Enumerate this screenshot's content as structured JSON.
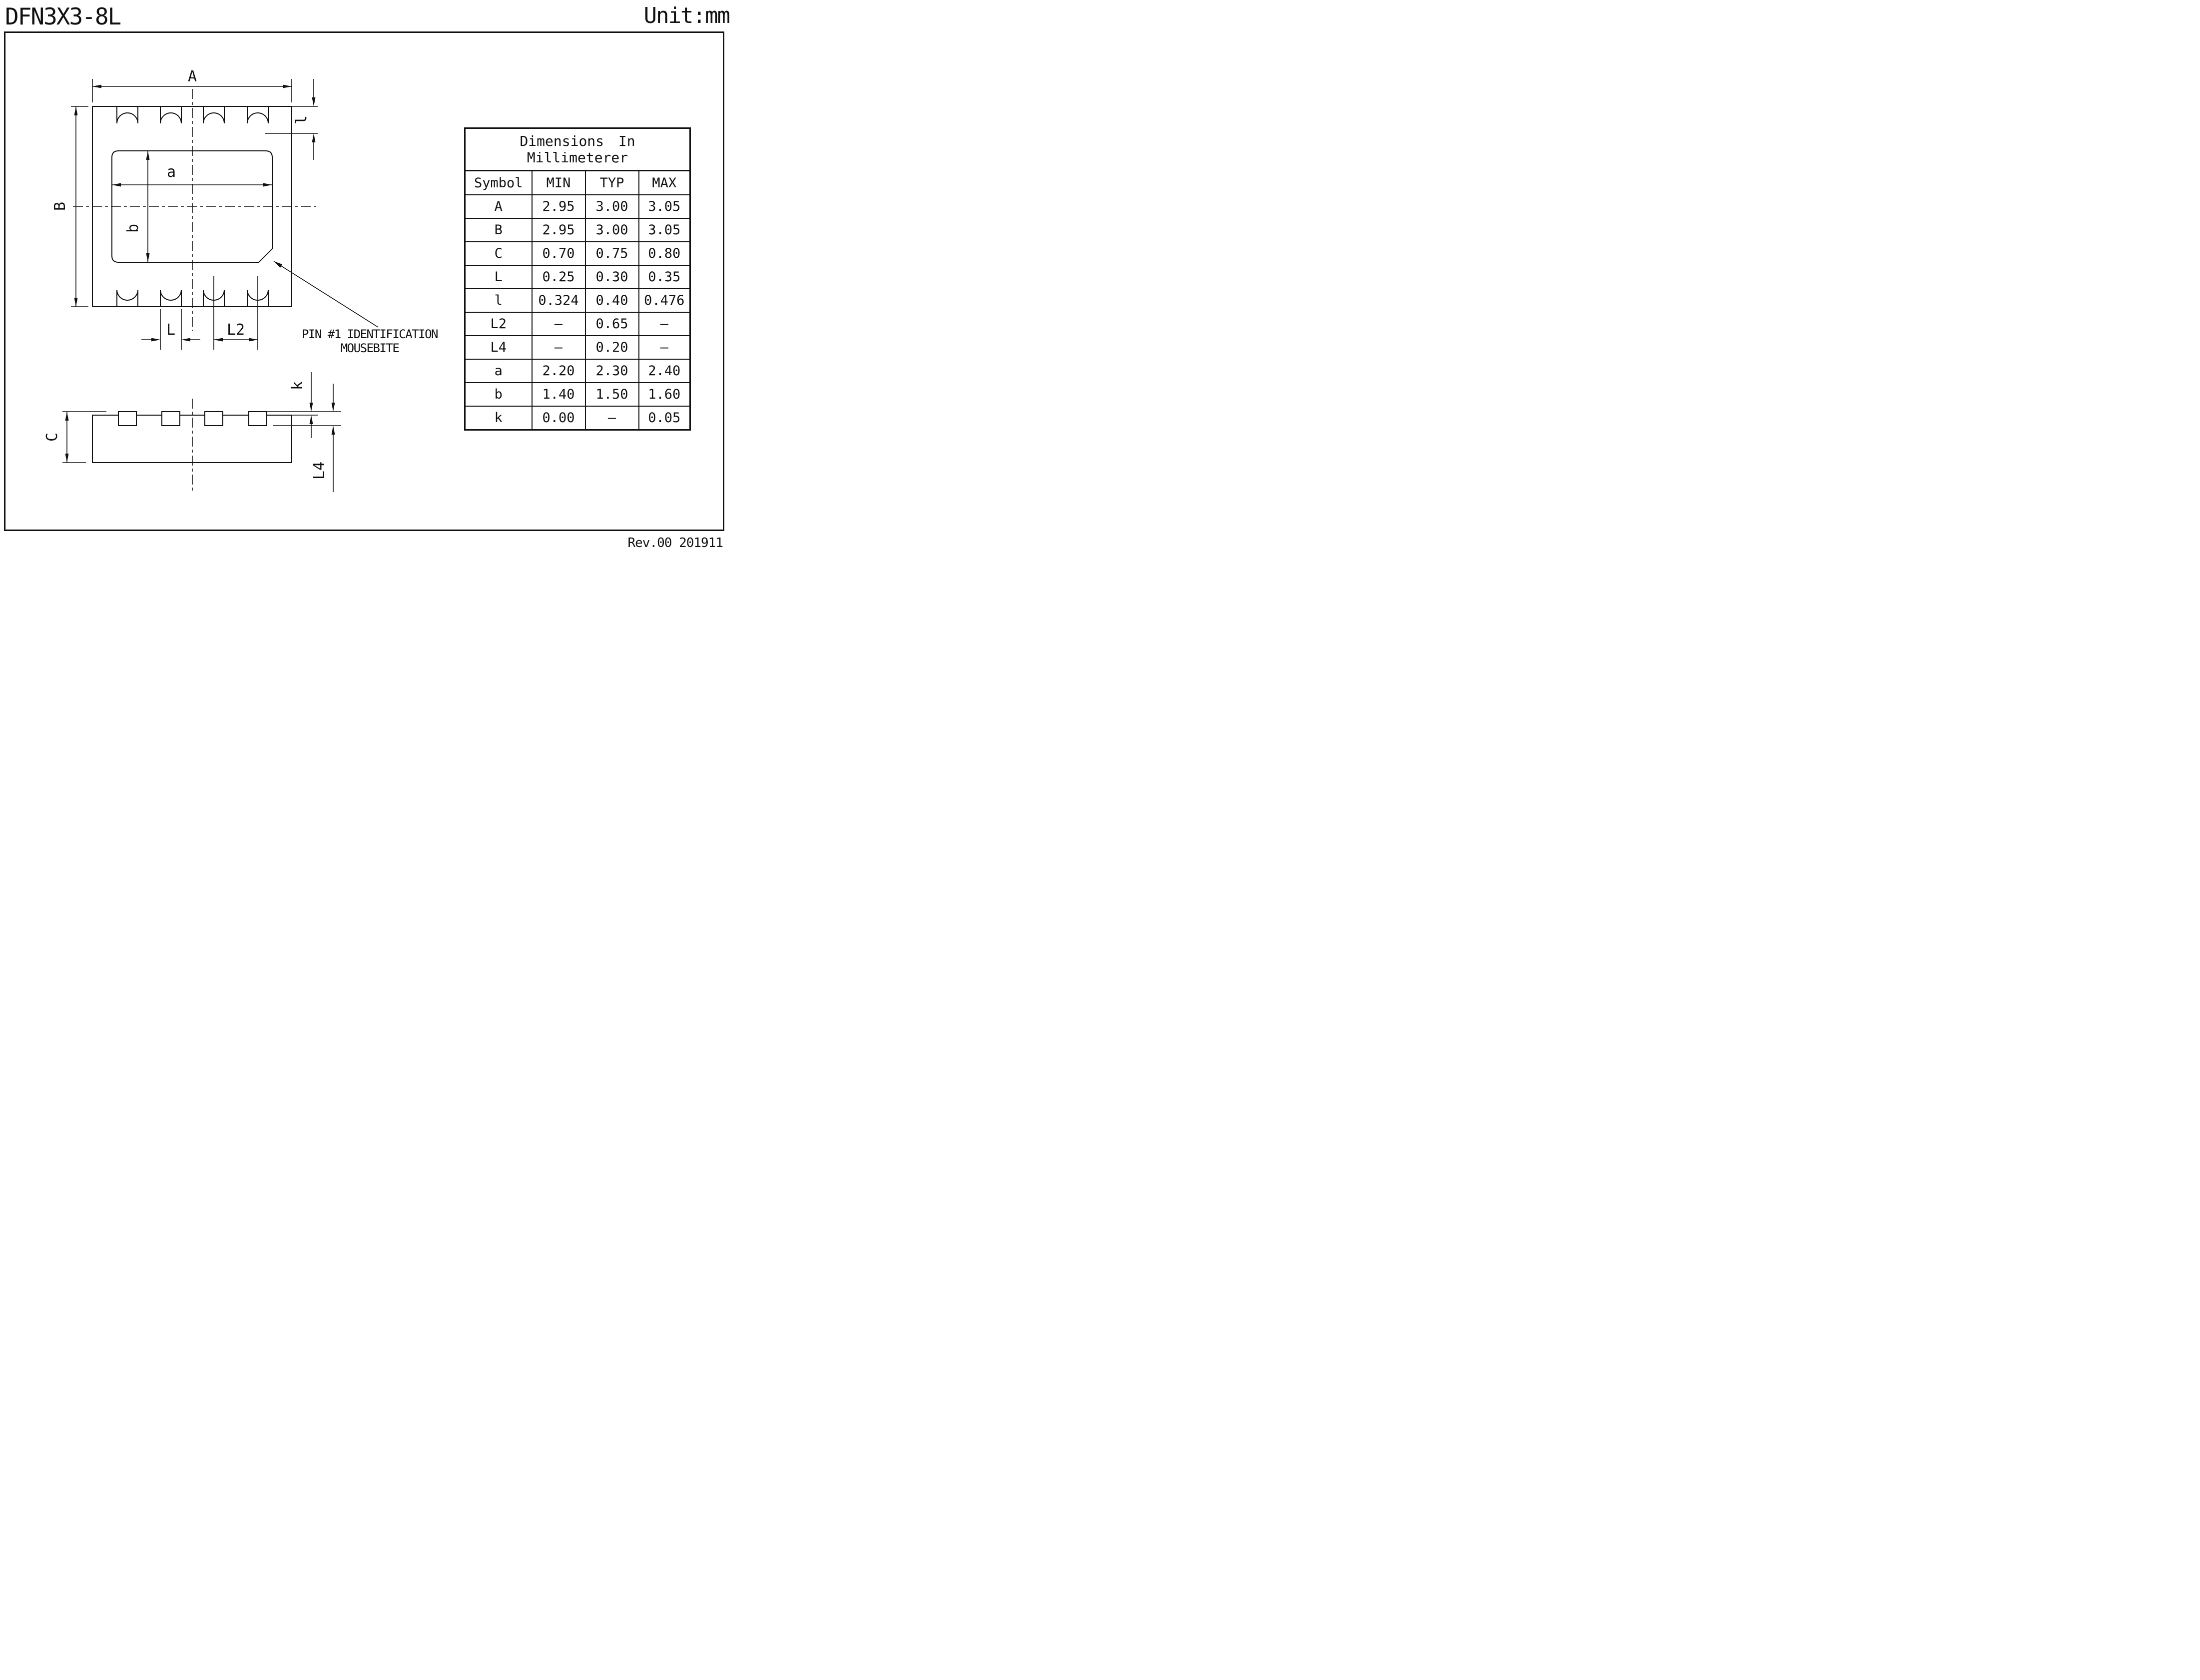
{
  "title": "DFN3X3-8L",
  "unit_label": "Unit:mm",
  "revision": "Rev.00 201911",
  "annotations": {
    "dim_A": "A",
    "dim_B": "B",
    "dim_a": "a",
    "dim_b": "b",
    "dim_l": "l",
    "dim_L": "L",
    "dim_L2": "L2",
    "dim_C": "C",
    "dim_k": "k",
    "dim_L4": "L4",
    "pin1_line1": "PIN #1 IDENTIFICATION",
    "pin1_line2": "MOUSEBITE"
  },
  "table": {
    "title_line1": "Dimensions In",
    "title_line2": "Millimeterer",
    "headers": [
      "Symbol",
      "MIN",
      "TYP",
      "MAX"
    ],
    "rows": [
      {
        "sym": "A",
        "min": "2.95",
        "typ": "3.00",
        "max": "3.05"
      },
      {
        "sym": "B",
        "min": "2.95",
        "typ": "3.00",
        "max": "3.05"
      },
      {
        "sym": "C",
        "min": "0.70",
        "typ": "0.75",
        "max": "0.80"
      },
      {
        "sym": "L",
        "min": "0.25",
        "typ": "0.30",
        "max": "0.35"
      },
      {
        "sym": "l",
        "min": "0.324",
        "typ": "0.40",
        "max": "0.476"
      },
      {
        "sym": "L2",
        "min": "–",
        "typ": "0.65",
        "max": "–"
      },
      {
        "sym": "L4",
        "min": "–",
        "typ": "0.20",
        "max": "–"
      },
      {
        "sym": "a",
        "min": "2.20",
        "typ": "2.30",
        "max": "2.40"
      },
      {
        "sym": "b",
        "min": "1.40",
        "typ": "1.50",
        "max": "1.60"
      },
      {
        "sym": "k",
        "min": "0.00",
        "typ": "–",
        "max": "0.05"
      }
    ]
  }
}
